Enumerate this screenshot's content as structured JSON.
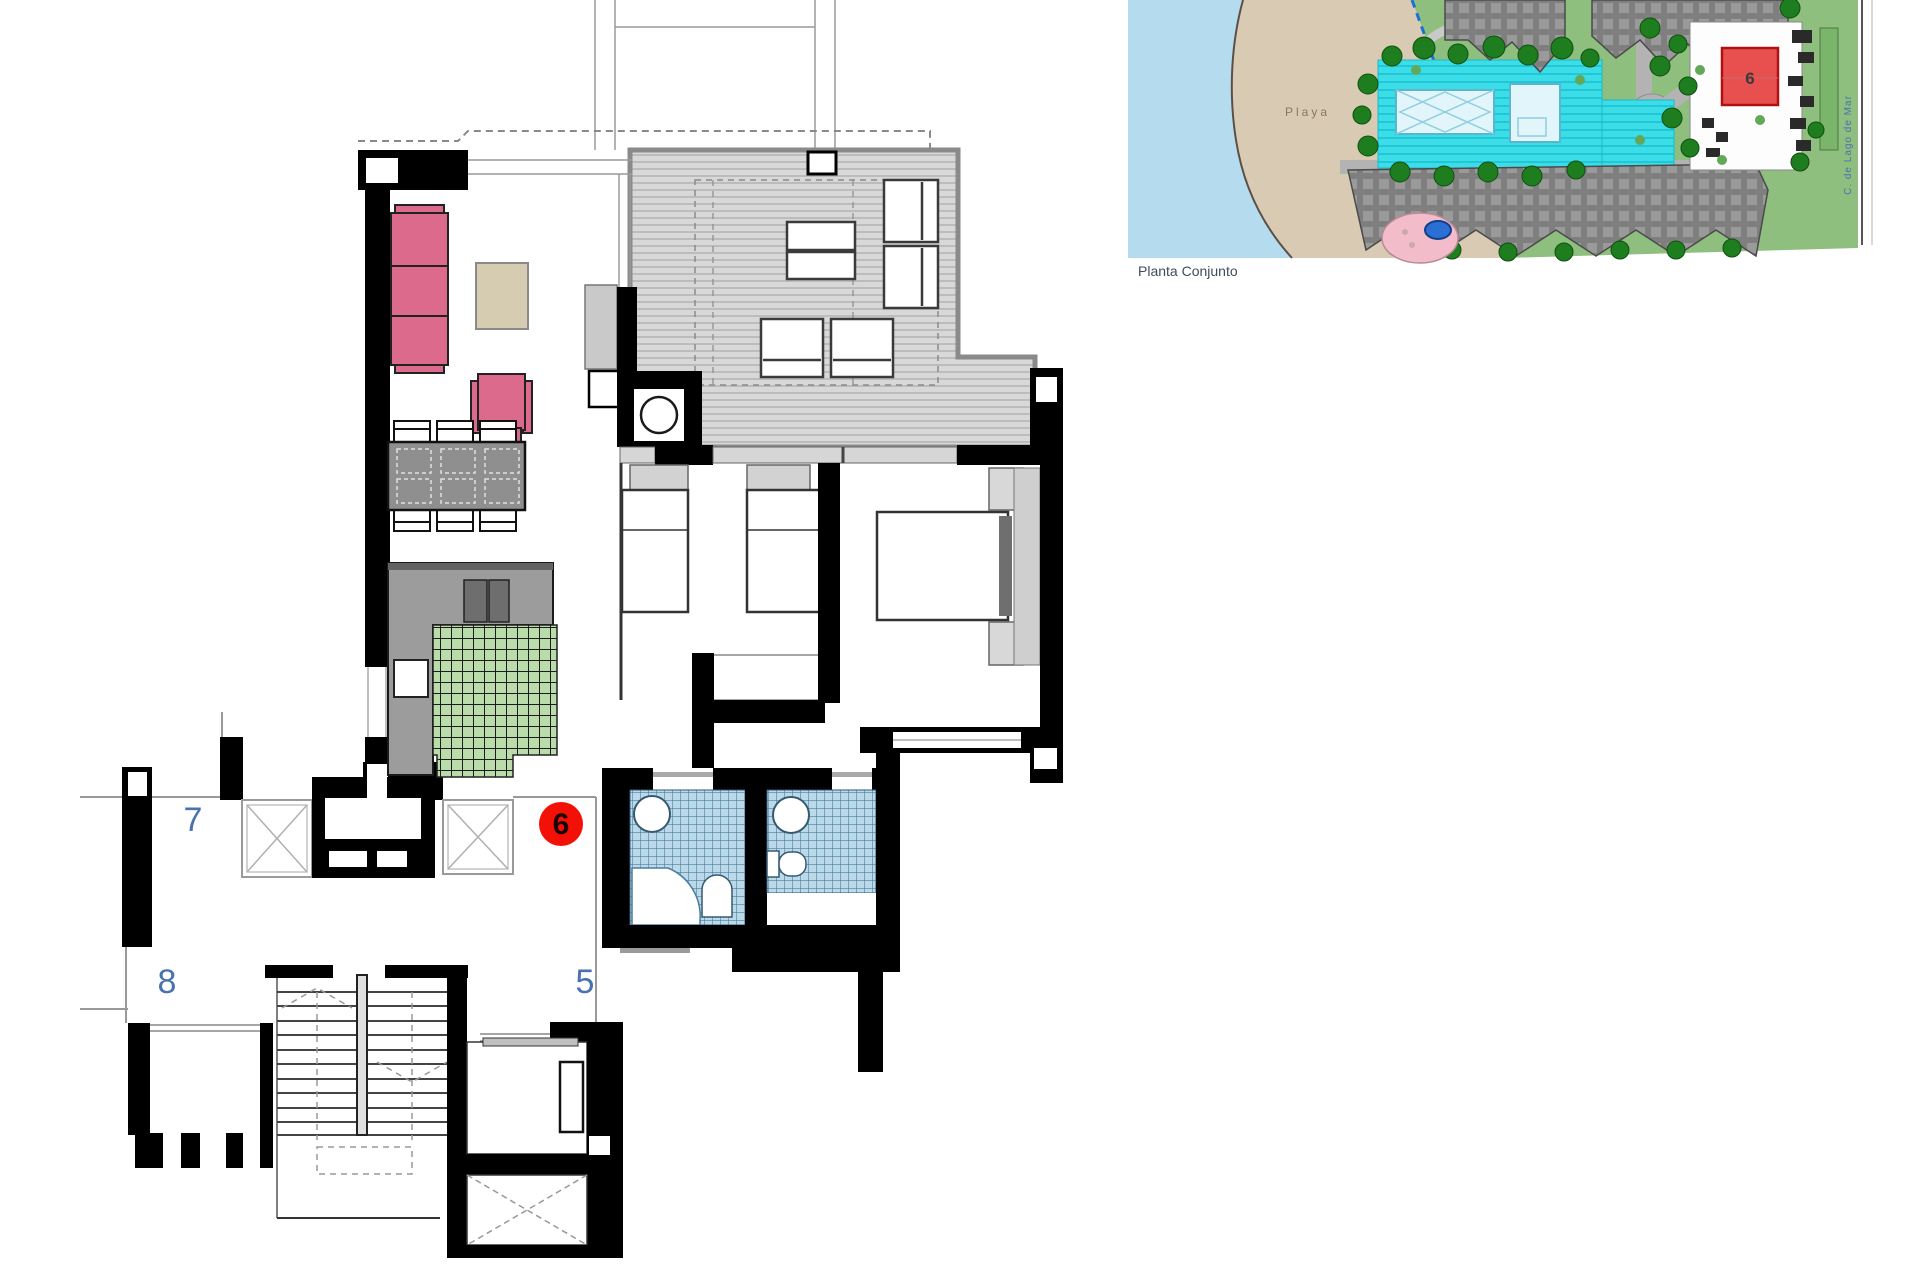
{
  "floor_plan": {
    "unit_badge": "6",
    "labels": {
      "unit_7": "7",
      "unit_8": "8",
      "unit_5": "5"
    }
  },
  "site_plan": {
    "caption": "Planta Conjunto",
    "beach_label": "Playa",
    "street_label": "C. de Lago de Mar",
    "highlighted_unit_label": "6"
  },
  "colors": {
    "wall": "#000000",
    "line_gray": "#999999",
    "terrace_fill": "#d8d8d8",
    "terrace_stripe": "#b6b6b6",
    "terrace_border": "#8a8a8a",
    "sofa_pink": "#dc6a8c",
    "rug_beige": "#d5ccb2",
    "furniture_gray": "#8f8f8f",
    "counter_gray": "#9c9c9c",
    "appliance_gray": "#6e6e6e",
    "kitchen_tile": "#b9dcaa",
    "bath_tile": "#bcd9ea",
    "bath_tile_line": "#4a7d9e",
    "unit_number_blue": "#4a71b0",
    "badge_red": "#f31007",
    "water": "#b5dcee",
    "sand": "#d9cbb3",
    "lawn": "#8fbf7f",
    "tree_green": "#1e7d1e",
    "pool_deck": "#3ddde8",
    "pool_water": "#e2f5fa",
    "building_gray": "#7f7f7f",
    "building_roof": "#9a9a9a",
    "site_red": "#e85050",
    "pink_area": "#f2bccb",
    "jacuzzi_blue": "#2a6fd4",
    "path_gray": "#b3b3b3"
  }
}
